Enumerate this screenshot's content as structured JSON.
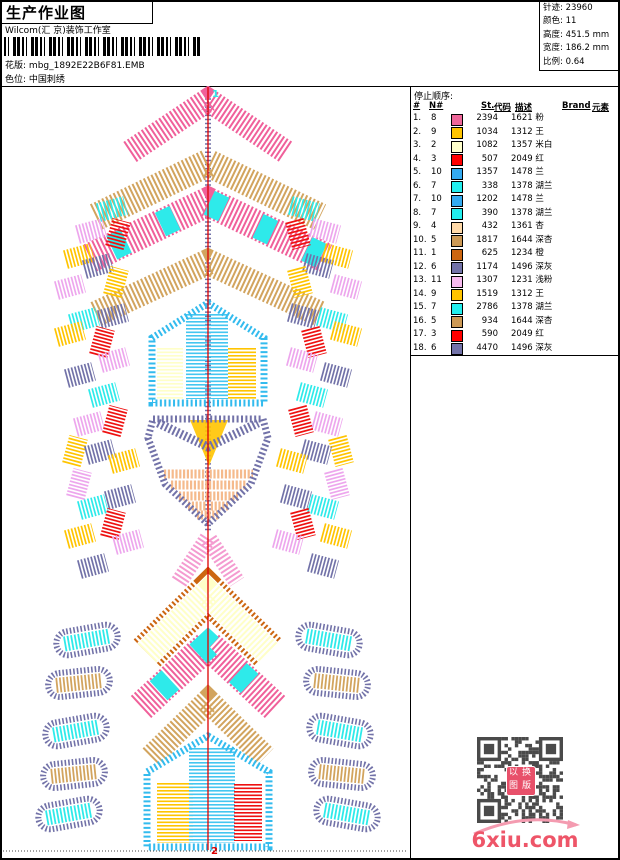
{
  "header": {
    "title": "生产作业图",
    "studio": "Wilcom(汇 京)装饰工作室",
    "pattern_label": "花版:",
    "pattern_value": "mbg_1892E22B6F81.EMB",
    "colorway_label": "色位:",
    "colorway_value": "中国刺绣"
  },
  "info": {
    "rows": [
      {
        "label": "针迹:",
        "value": "23960"
      },
      {
        "label": "颜色:",
        "value": "11"
      },
      {
        "label": "高度:",
        "value": "451.5 mm"
      },
      {
        "label": "宽度:",
        "value": "186.2 mm"
      },
      {
        "label": "比例:",
        "value": "0.64"
      }
    ]
  },
  "stop_sequence": {
    "title": "停止顺序:",
    "columns": [
      {
        "label": "#",
        "left": 3
      },
      {
        "label": "N#",
        "left": 19
      },
      {
        "label": "St.",
        "left": 71
      },
      {
        "label": "代码",
        "left": 84
      },
      {
        "label": "描述",
        "left": 105
      },
      {
        "label": "Brand",
        "left": 152
      },
      {
        "label": "元素",
        "left": 182
      }
    ],
    "rows": [
      {
        "seq": "1.",
        "n": "8",
        "color": "#EE6699",
        "st": "2394",
        "desc": "1621 粉"
      },
      {
        "seq": "2.",
        "n": "9",
        "color": "#FFC400",
        "st": "1034",
        "desc": "1312 王"
      },
      {
        "seq": "3.",
        "n": "2",
        "color": "#FFFFCC",
        "st": "1082",
        "desc": "1357 米白"
      },
      {
        "seq": "4.",
        "n": "3",
        "color": "#FF0000",
        "st": "507",
        "desc": "2049 红"
      },
      {
        "seq": "5.",
        "n": "10",
        "color": "#33AAF0",
        "st": "1357",
        "desc": "1478 兰"
      },
      {
        "seq": "6.",
        "n": "7",
        "color": "#22EEEE",
        "st": "338",
        "desc": "1378 湖兰"
      },
      {
        "seq": "7.",
        "n": "10",
        "color": "#33AAF0",
        "st": "1202",
        "desc": "1478 兰"
      },
      {
        "seq": "8.",
        "n": "7",
        "color": "#22EEEE",
        "st": "390",
        "desc": "1378 湖兰"
      },
      {
        "seq": "9.",
        "n": "4",
        "color": "#FFD9A8",
        "st": "432",
        "desc": "1361 杏"
      },
      {
        "seq": "10.",
        "n": "5",
        "color": "#CC9955",
        "st": "1817",
        "desc": "1644 深杏"
      },
      {
        "seq": "11.",
        "n": "1",
        "color": "#CC6611",
        "st": "625",
        "desc": "1234 橙"
      },
      {
        "seq": "12.",
        "n": "6",
        "color": "#7272A8",
        "st": "1174",
        "desc": "1496 深灰"
      },
      {
        "seq": "13.",
        "n": "11",
        "color": "#F8BBF0",
        "st": "1307",
        "desc": "1231 浅粉"
      },
      {
        "seq": "14.",
        "n": "9",
        "color": "#FFC400",
        "st": "1519",
        "desc": "1312 王"
      },
      {
        "seq": "15.",
        "n": "7",
        "color": "#22EEEE",
        "st": "2786",
        "desc": "1378 湖兰"
      },
      {
        "seq": "16.",
        "n": "5",
        "color": "#CC9955",
        "st": "934",
        "desc": "1644 深杏"
      },
      {
        "seq": "17.",
        "n": "3",
        "color": "#FF0000",
        "st": "590",
        "desc": "2049 红"
      },
      {
        "seq": "18.",
        "n": "6",
        "color": "#7272A8",
        "st": "4470",
        "desc": "1496 深灰"
      }
    ]
  },
  "design": {
    "label_top": "1",
    "label_bottom": "2",
    "palette": {
      "pink": "#F0609A",
      "tan": "#D2A45E",
      "cream": "#FFFFC8",
      "red": "#EE1111",
      "sky": "#33BBEE",
      "sky2": "#44C6F0",
      "cyan": "#2EEAEA",
      "gold": "#FFC400",
      "slate": "#7272A8",
      "violet": "#EDA6ED",
      "lightpink": "#F49BD0",
      "peach": "#F5BA8C",
      "brown": "#CC6611",
      "axis": "#DD0000"
    },
    "chevrons": [
      {
        "ay": 14,
        "dx": 78,
        "dy": 52,
        "w": 24,
        "c": "pink"
      },
      {
        "ay": 77,
        "dx": 112,
        "dy": 54,
        "w": 28,
        "c": "tan"
      },
      {
        "ay": 116,
        "dx": 118,
        "dy": 56,
        "w": 30,
        "c": "pink",
        "o": "cyan"
      },
      {
        "ay": 176,
        "dx": 112,
        "dy": 52,
        "w": 26,
        "c": "tan"
      },
      {
        "ay": 452,
        "dx": 29,
        "dy": 44,
        "w": 17,
        "c": "lightpink"
      },
      {
        "ay": 507,
        "dx": 61,
        "dy": 60,
        "w": 26,
        "c": "cream",
        "edge": "brown"
      },
      {
        "ay": 559,
        "dx": 67,
        "dy": 62,
        "w": 30,
        "c": "pink",
        "o": "cyan"
      },
      {
        "ay": 615,
        "dx": 57,
        "dy": 56,
        "w": 24,
        "c": "tan"
      }
    ],
    "houses": [
      {
        "ax": 207,
        "ay": 217,
        "x1": 151,
        "x2": 263,
        "eave": 252,
        "bottom": 317,
        "outline": "sky",
        "panels": [
          {
            "x": 169,
            "w": 26,
            "y1": 262,
            "y2": 313,
            "c": "cream"
          },
          {
            "x": 206,
            "w": 42,
            "y1": 228,
            "y2": 313,
            "c": "sky2"
          },
          {
            "x": 241,
            "w": 28,
            "y1": 262,
            "y2": 313,
            "c": "gold"
          }
        ]
      },
      {
        "ax": 207,
        "ay": 650,
        "x1": 146,
        "x2": 268,
        "eave": 686,
        "bottom": 761,
        "outline": "sky",
        "panels": [
          {
            "x": 174,
            "w": 36,
            "y1": 697,
            "y2": 757,
            "c": "gold"
          },
          {
            "x": 211,
            "w": 46,
            "y1": 662,
            "y2": 757,
            "c": "sky2"
          },
          {
            "x": 247,
            "w": 28,
            "y1": 698,
            "y2": 755,
            "c": "red"
          }
        ]
      }
    ],
    "shield": {
      "pts": [
        [
          152,
          333
        ],
        [
          262,
          333
        ],
        [
          267,
          352
        ],
        [
          250,
          398
        ],
        [
          207,
          438
        ],
        [
          164,
          398
        ],
        [
          147,
          352
        ]
      ],
      "outline": "slate",
      "chevron": {
        "pts": [
          [
            157,
            337
          ],
          [
            207,
            361
          ],
          [
            257,
            337
          ]
        ],
        "w": 9,
        "c": "slate"
      },
      "triangle": {
        "pts": [
          [
            189,
            334
          ],
          [
            227,
            334
          ],
          [
            208,
            380
          ]
        ],
        "c": "gold"
      },
      "hatch_c": "peach",
      "hatch": [
        {
          "y": 388,
          "x1": 163,
          "x2": 252
        },
        {
          "y": 399,
          "x1": 170,
          "x2": 245
        },
        {
          "y": 410,
          "x1": 178,
          "x2": 237
        },
        {
          "y": 420,
          "x1": 187,
          "x2": 227
        },
        {
          "y": 429,
          "x1": 196,
          "x2": 218
        }
      ]
    },
    "patches": [
      [
        111,
        123,
        -15,
        "cyan"
      ],
      [
        90,
        145,
        -15,
        "violet"
      ],
      [
        117,
        148,
        -75,
        "red"
      ],
      [
        78,
        170,
        -15,
        "gold"
      ],
      [
        97,
        180,
        -15,
        "slate"
      ],
      [
        115,
        196,
        -75,
        "gold"
      ],
      [
        69,
        201,
        -15,
        "violet"
      ],
      [
        83,
        234,
        -15,
        "cyan"
      ],
      [
        112,
        230,
        -15,
        "slate"
      ],
      [
        69,
        248,
        -15,
        "gold"
      ],
      [
        101,
        256,
        -75,
        "red"
      ],
      [
        113,
        274,
        -15,
        "violet"
      ],
      [
        79,
        289,
        -15,
        "slate"
      ],
      [
        103,
        309,
        -15,
        "cyan"
      ],
      [
        88,
        338,
        -15,
        "violet"
      ],
      [
        114,
        335,
        -75,
        "red"
      ],
      [
        74,
        365,
        -75,
        "gold"
      ],
      [
        99,
        366,
        -15,
        "slate"
      ],
      [
        123,
        375,
        -15,
        "gold"
      ],
      [
        78,
        398,
        -75,
        "violet"
      ],
      [
        92,
        421,
        -15,
        "cyan"
      ],
      [
        119,
        411,
        -15,
        "slate"
      ],
      [
        112,
        438,
        -75,
        "red"
      ],
      [
        79,
        450,
        -15,
        "gold"
      ],
      [
        127,
        456,
        -15,
        "violet"
      ],
      [
        92,
        480,
        -15,
        "slate"
      ]
    ],
    "pills": [
      [
        86,
        554,
        -10,
        "cyan"
      ],
      [
        78,
        597,
        -6,
        "tan"
      ],
      [
        75,
        645,
        -10,
        "cyan"
      ],
      [
        73,
        688,
        -6,
        "tan"
      ],
      [
        68,
        728,
        -10,
        "cyan"
      ]
    ],
    "travel": {
      "x": 207,
      "y1": 4,
      "y2": 446,
      "c": "slate"
    },
    "axis": {
      "x": 207,
      "y1": 1,
      "y2": 764
    },
    "dotted_y": 765
  },
  "footer": {
    "qr_stamp": [
      "以",
      "换",
      "图",
      "版"
    ],
    "site": "6xiu.com"
  }
}
